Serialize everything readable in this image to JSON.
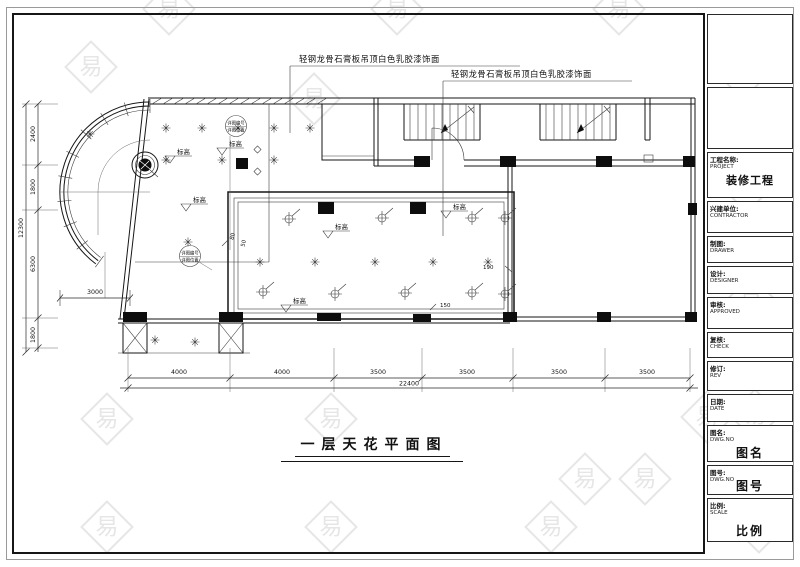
{
  "sheet": {
    "drawing_title": "一层天花平面图",
    "ceiling_note_1": "轻钢龙骨石膏板吊顶白色乳胶漆饰面",
    "ceiling_note_2": "轻钢龙骨石膏板吊顶白色乳胶漆饰面",
    "elevation_label": "标高",
    "detail_tag": {
      "line1": "详图编号",
      "line2": "详图位置"
    },
    "watermark_glyph": "易"
  },
  "dims": {
    "bottom_segments": [
      "4000",
      "4000",
      "3500",
      "3500",
      "3500",
      "3500"
    ],
    "bottom_total": "22400",
    "left_segments": [
      "2400",
      "1800",
      "6300",
      "1800"
    ],
    "left_total": "12300",
    "interior": "3000",
    "detail_dims": {
      "d80": "80",
      "d50": "50",
      "d190": "190",
      "d150": "150"
    }
  },
  "title_block": {
    "rows": [
      {
        "label": "工程名称:",
        "sub": "PROJECT",
        "big": "装修工程"
      },
      {
        "label": "兴建单位:",
        "sub": "CONTRACTOR",
        "big": ""
      },
      {
        "label": "制图:",
        "sub": "DRAWER",
        "big": ""
      },
      {
        "label": "设计:",
        "sub": "DESIGNER",
        "big": ""
      },
      {
        "label": "审核:",
        "sub": "APPROVED",
        "big": ""
      },
      {
        "label": "复核:",
        "sub": "CHECK",
        "big": ""
      },
      {
        "label": "修订:",
        "sub": "REV",
        "big": ""
      },
      {
        "label": "日期:",
        "sub": "DATE",
        "big": ""
      },
      {
        "label": "图名:",
        "sub": "DWG.NO",
        "big": "图名"
      },
      {
        "label": "图号:",
        "sub": "DWG.NO",
        "big": "图号"
      },
      {
        "label": "比例:",
        "sub": "SCALE",
        "big": "比例"
      }
    ]
  },
  "colors": {
    "line": "#161616",
    "paper": "#ffffff",
    "watermark": "#dedede"
  }
}
